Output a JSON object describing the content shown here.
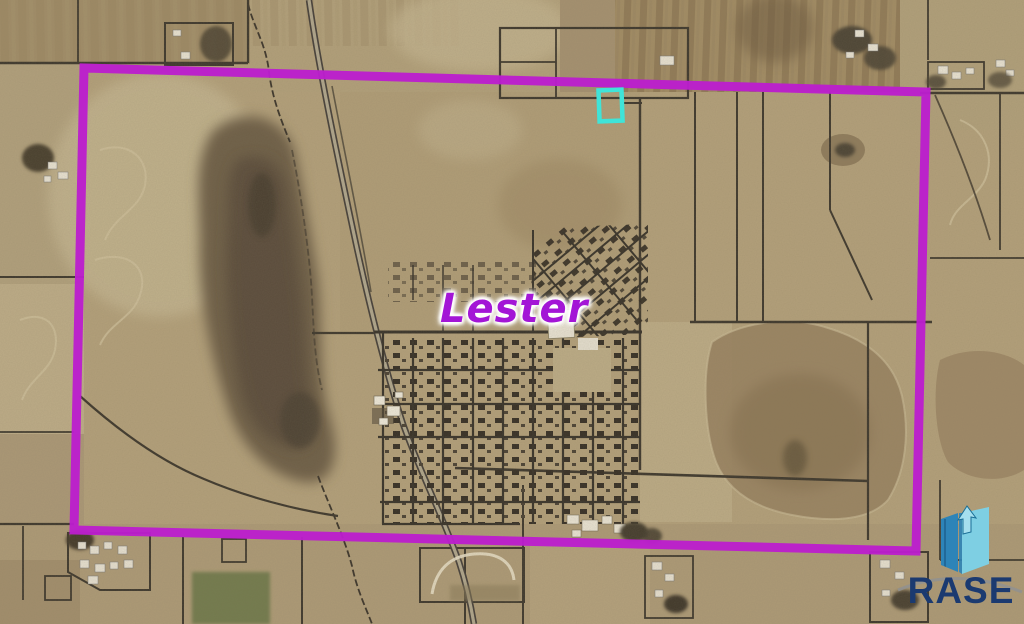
{
  "annotations": {
    "town_label": "Lester",
    "boundary_box": "section-boundary",
    "parcel_marker": "highlighted-parcel"
  },
  "branding": {
    "logo_text": "RASE",
    "logo_icon": "rase-book-arrow-icon"
  },
  "colors": {
    "boundary": "#bb1ecd",
    "marker": "#3fe4d8",
    "town_label": "#a316d6",
    "logo_text": "#1b3a70",
    "logo_icon_dark": "#2d84b8",
    "logo_icon_light": "#7ecfe3",
    "logo_icon_arrow": "#a5dfee",
    "logo_arc": "#919191"
  }
}
